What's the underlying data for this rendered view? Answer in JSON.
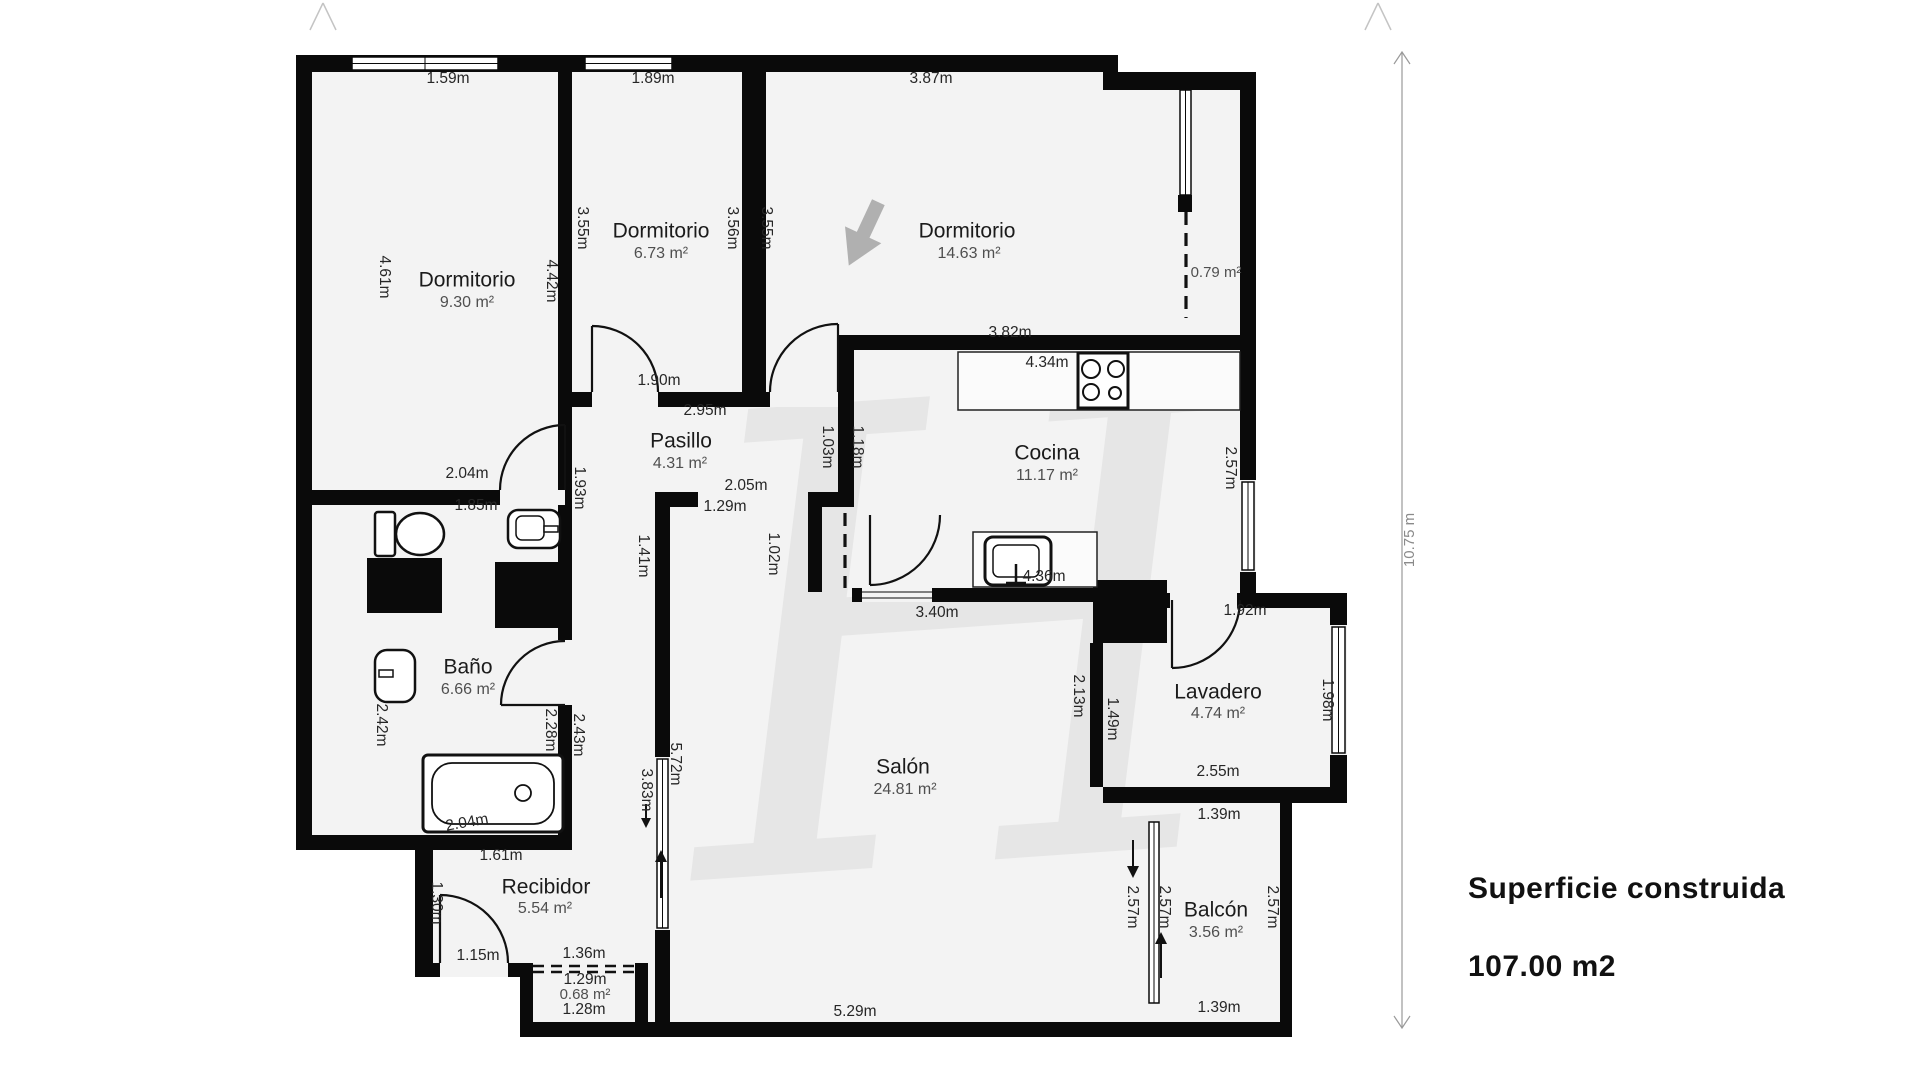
{
  "summary": {
    "title": "Superficie construida",
    "value": "107.00 m2"
  },
  "watermark": {
    "glyph": "H"
  },
  "colors": {
    "wall": "#0a0a0a",
    "floor": "#f3f3f3",
    "page": "#ffffff",
    "measurement_text": "#262626",
    "room_text": "#1b1b1b",
    "area_text": "#4f4f4f",
    "dimension_line": "#9a9a9a",
    "watermark": "#dcdcdc",
    "compass_arrow": "#b0b0b0"
  },
  "floorplan": {
    "dimension_line": {
      "label": "10.75 m",
      "pos": [
        1410,
        540
      ],
      "rot": -90
    },
    "rooms": [
      {
        "name": "Dormitorio",
        "area": "9.30 m²",
        "name_pos": [
          467,
          281
        ],
        "area_pos": [
          467,
          303
        ]
      },
      {
        "name": "Dormitorio",
        "area": "6.73 m²",
        "name_pos": [
          661,
          232
        ],
        "area_pos": [
          661,
          254
        ]
      },
      {
        "name": "Dormitorio",
        "area": "14.63 m²",
        "name_pos": [
          967,
          232
        ],
        "area_pos": [
          969,
          254
        ]
      },
      {
        "name": "Pasillo",
        "area": "4.31 m²",
        "name_pos": [
          681,
          442
        ],
        "area_pos": [
          680,
          464
        ]
      },
      {
        "name": "Cocina",
        "area": "11.17 m²",
        "name_pos": [
          1047,
          454
        ],
        "area_pos": [
          1047,
          476
        ]
      },
      {
        "name": "Baño",
        "area": "6.66 m²",
        "name_pos": [
          468,
          668
        ],
        "area_pos": [
          468,
          690
        ]
      },
      {
        "name": "Salón",
        "area": "24.81 m²",
        "name_pos": [
          903,
          768
        ],
        "area_pos": [
          905,
          790
        ]
      },
      {
        "name": "Recibidor",
        "area": "5.54 m²",
        "name_pos": [
          546,
          888
        ],
        "area_pos": [
          545,
          909
        ]
      },
      {
        "name": "Lavadero",
        "area": "4.74 m²",
        "name_pos": [
          1218,
          693
        ],
        "area_pos": [
          1218,
          714
        ]
      },
      {
        "name": "Balcón",
        "area": "3.56 m²",
        "name_pos": [
          1216,
          911
        ],
        "area_pos": [
          1216,
          933
        ]
      }
    ],
    "unlabeled_areas": [
      {
        "area": "0.79 m²",
        "pos": [
          1216,
          273
        ]
      },
      {
        "area": "0.68 m²",
        "pos": [
          585,
          995
        ]
      }
    ],
    "measurements": [
      {
        "t": "1.59m",
        "x": 448,
        "y": 79
      },
      {
        "t": "1.89m",
        "x": 653,
        "y": 79
      },
      {
        "t": "3.87m",
        "x": 931,
        "y": 79
      },
      {
        "t": "4.61m",
        "x": 384,
        "y": 277,
        "r": 90
      },
      {
        "t": "4.42m",
        "x": 551,
        "y": 281,
        "r": 90
      },
      {
        "t": "3.55m",
        "x": 582,
        "y": 228,
        "r": 90
      },
      {
        "t": "3.56m",
        "x": 732,
        "y": 228,
        "r": 90
      },
      {
        "t": "3.55m",
        "x": 766,
        "y": 228,
        "r": 90
      },
      {
        "t": "2.04m",
        "x": 467,
        "y": 474
      },
      {
        "t": "1.90m",
        "x": 659,
        "y": 381
      },
      {
        "t": "2.95m",
        "x": 705,
        "y": 411
      },
      {
        "t": "3.82m",
        "x": 1010,
        "y": 333
      },
      {
        "t": "4.34m",
        "x": 1047,
        "y": 363
      },
      {
        "t": "1.03m",
        "x": 827,
        "y": 447,
        "r": 90
      },
      {
        "t": "1.18m",
        "x": 857,
        "y": 447,
        "r": 90
      },
      {
        "t": "2.57m",
        "x": 1230,
        "y": 468,
        "r": 90
      },
      {
        "t": "1.93m",
        "x": 579,
        "y": 488,
        "r": 90
      },
      {
        "t": "2.05m",
        "x": 746,
        "y": 486
      },
      {
        "t": "1.29m",
        "x": 725,
        "y": 507
      },
      {
        "t": "1.85m",
        "x": 476,
        "y": 506
      },
      {
        "t": "1.41m",
        "x": 643,
        "y": 556,
        "r": 90
      },
      {
        "t": "1.02m",
        "x": 773,
        "y": 554,
        "r": 90
      },
      {
        "t": "3.40m",
        "x": 937,
        "y": 613
      },
      {
        "t": "4.36m",
        "x": 1044,
        "y": 577
      },
      {
        "t": "1.92m",
        "x": 1245,
        "y": 611
      },
      {
        "t": "2.42m",
        "x": 381,
        "y": 725,
        "r": 90
      },
      {
        "t": "2.28m",
        "x": 550,
        "y": 730,
        "r": 90
      },
      {
        "t": "2.43m",
        "x": 578,
        "y": 735,
        "r": 90
      },
      {
        "t": "2.13m",
        "x": 1078,
        "y": 696,
        "r": 90
      },
      {
        "t": "1.49m",
        "x": 1112,
        "y": 719,
        "r": 90
      },
      {
        "t": "1.98m",
        "x": 1327,
        "y": 700,
        "r": 90
      },
      {
        "t": "2.55m",
        "x": 1218,
        "y": 772
      },
      {
        "t": "1.39m",
        "x": 1219,
        "y": 815
      },
      {
        "t": "5.72m",
        "x": 675,
        "y": 764,
        "r": 90
      },
      {
        "t": "3.83m",
        "x": 646,
        "y": 790,
        "r": 90
      },
      {
        "t": "2.04m",
        "x": 467,
        "y": 823,
        "r": -10
      },
      {
        "t": "1.61m",
        "x": 501,
        "y": 856
      },
      {
        "t": "1.30m",
        "x": 436,
        "y": 903,
        "r": 90
      },
      {
        "t": "1.15m",
        "x": 478,
        "y": 956
      },
      {
        "t": "1.36m",
        "x": 584,
        "y": 954
      },
      {
        "t": "1.29m",
        "x": 585,
        "y": 980
      },
      {
        "t": "1.28m",
        "x": 584,
        "y": 1010
      },
      {
        "t": "5.29m",
        "x": 855,
        "y": 1012
      },
      {
        "t": "2.57m",
        "x": 1132,
        "y": 907,
        "r": 90
      },
      {
        "t": "2.57m",
        "x": 1164,
        "y": 907,
        "r": 90
      },
      {
        "t": "2.57m",
        "x": 1272,
        "y": 907,
        "r": 90
      },
      {
        "t": "1.39m",
        "x": 1219,
        "y": 1008
      }
    ]
  }
}
